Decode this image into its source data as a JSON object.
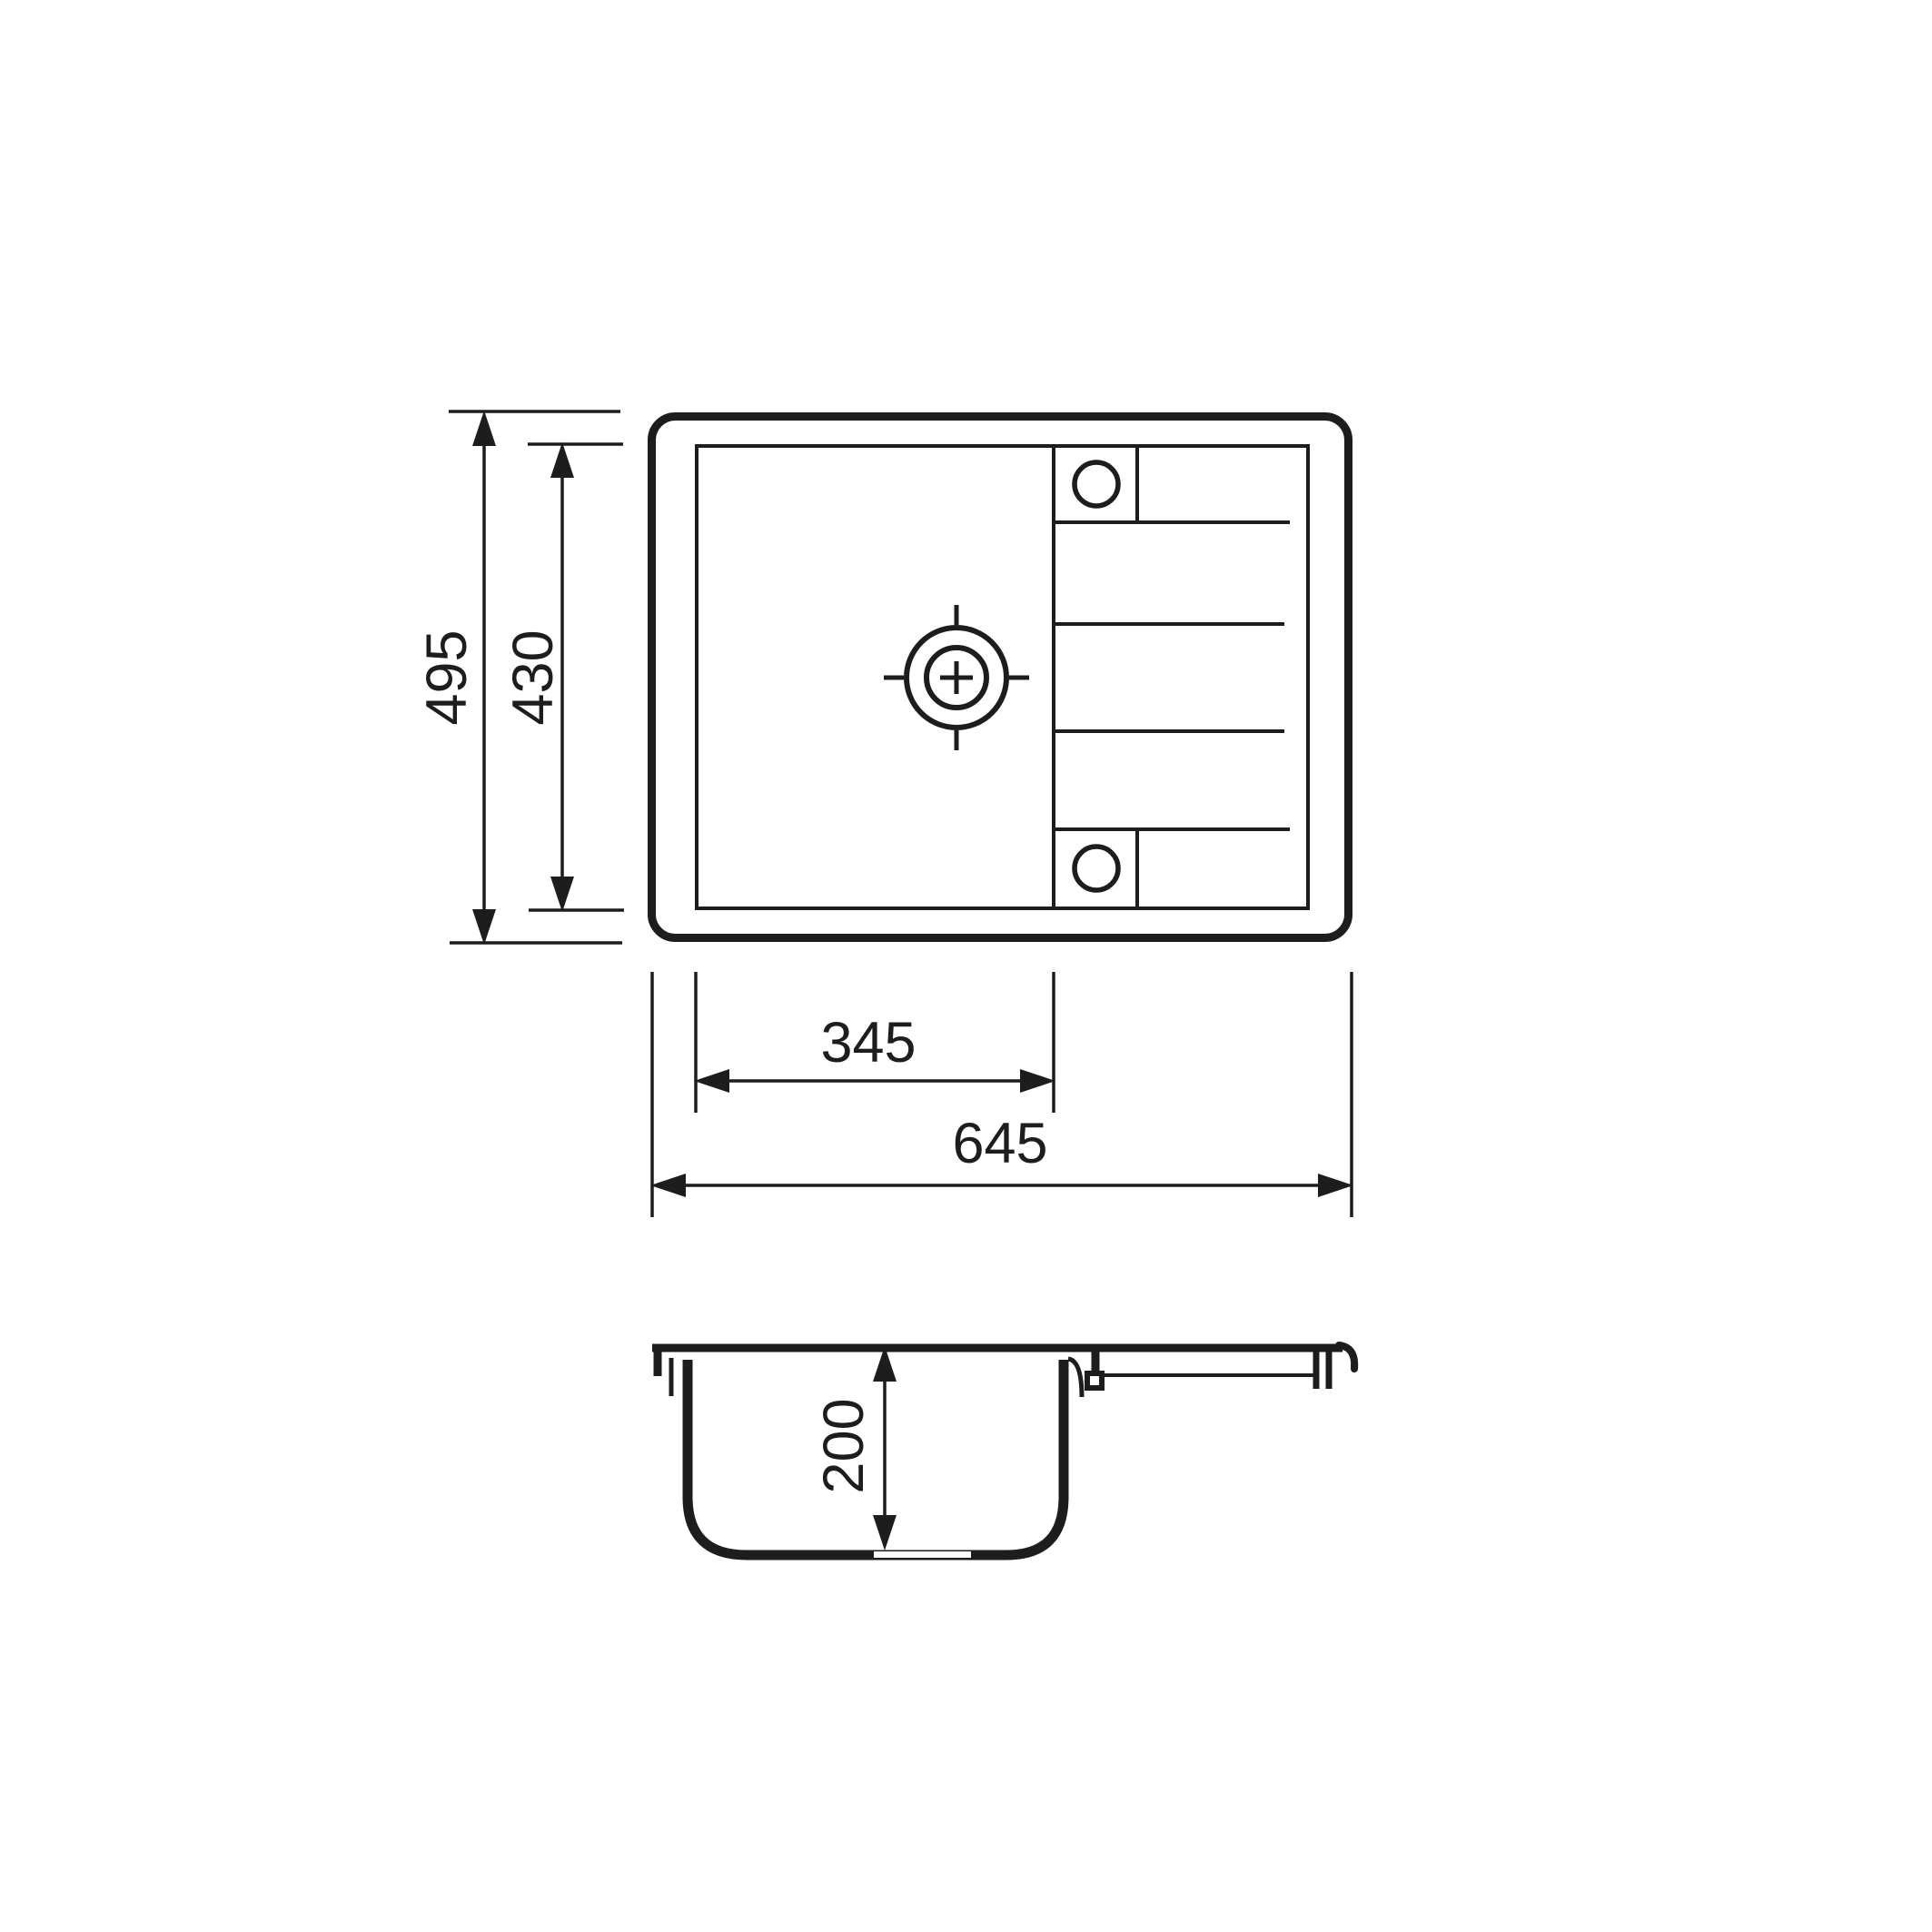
{
  "drawing": {
    "background": "#ffffff",
    "line_color": "#1d1d1d",
    "dimensions": {
      "overall_height": {
        "label": "495"
      },
      "inner_height": {
        "label": "430"
      },
      "bowl_width": {
        "label": "345"
      },
      "overall_width": {
        "label": "645"
      },
      "bowl_depth": {
        "label": "200"
      }
    }
  }
}
